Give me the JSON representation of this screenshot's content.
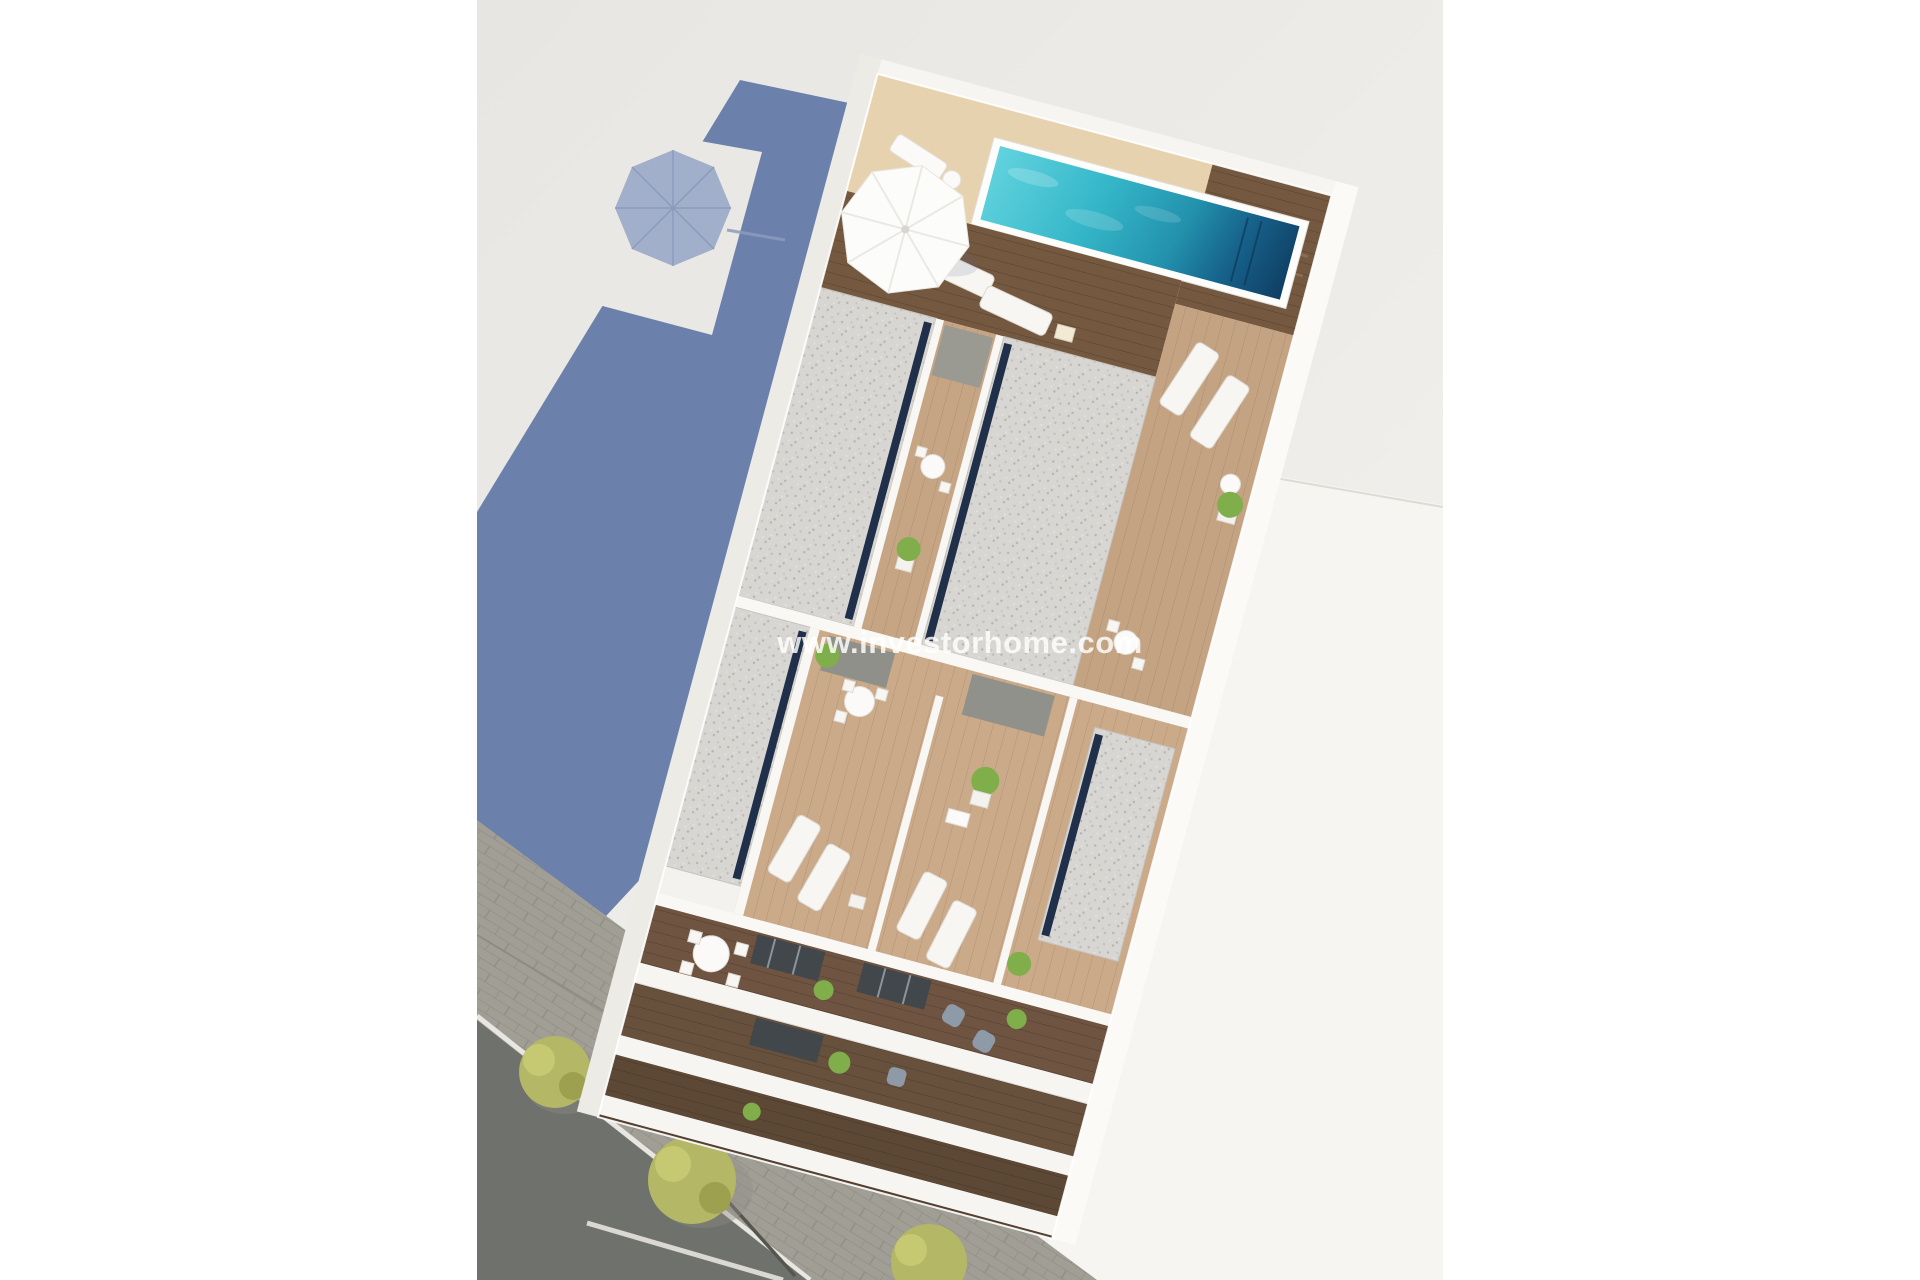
{
  "watermark": {
    "text": "www.investorhome.com"
  },
  "colors": {
    "page_background": "#ffffff",
    "ground_light": "#eae8e4",
    "ground_bright": "#f6f5f2",
    "shadow_blue": "#6b80ab",
    "shadow_umbrella": "#95a6c6",
    "pool_light": "#4cc8d7",
    "pool_dark": "#123f5e",
    "deck_sand": "#e6d2ae",
    "wood_light": "#cbaa8a",
    "wood_dark": "#74583f",
    "gravel": "#d8d6d2",
    "navy_edge": "#20304a",
    "white_wall": "#f8f7f4",
    "asphalt": "#6f716c",
    "sidewalk": "#a19e96",
    "tree_olive": "#b4b765",
    "plant_green": "#7fae4a",
    "armchair_gray": "#8e9aa8",
    "glass_dark": "#41474b"
  }
}
